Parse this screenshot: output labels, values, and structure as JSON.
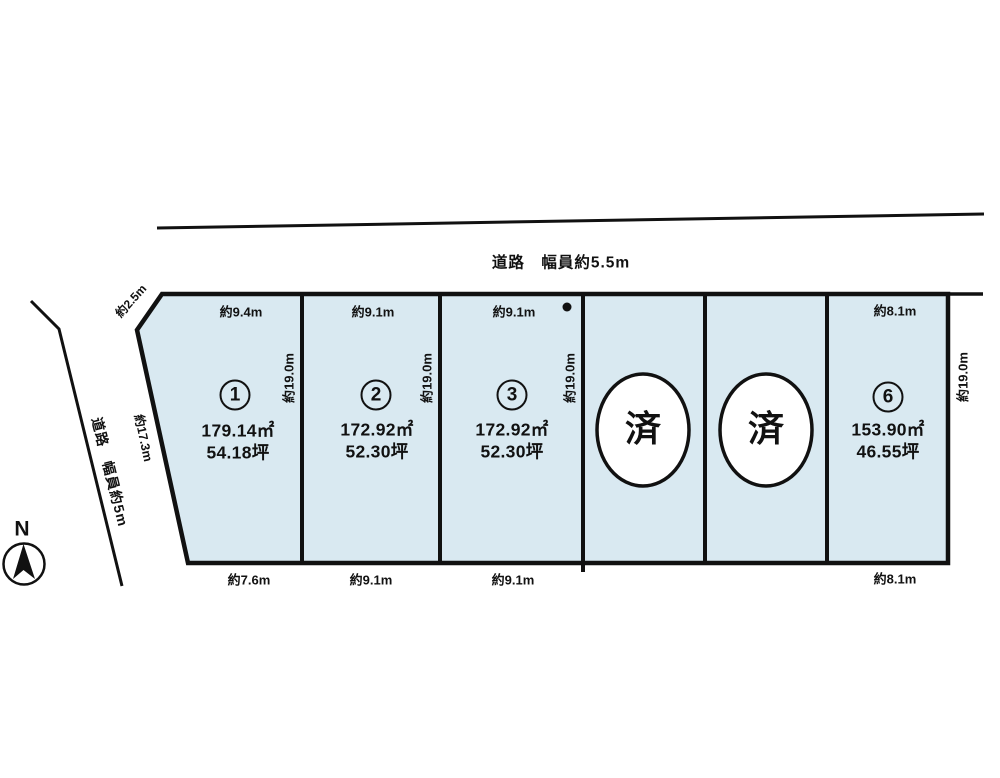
{
  "roads": {
    "top_label": "道路　幅員約5.5m",
    "left_label": "道路　幅員約5m"
  },
  "compass": {
    "north": "N"
  },
  "boundary_labels": {
    "corner_cut": "約2.5m",
    "left_slant_edge": "約17.3m"
  },
  "plots": [
    {
      "number": "1",
      "area_m2": "179.14㎡",
      "area_tsubo": "54.18坪",
      "width_top": "約9.4m",
      "width_bottom": "約7.6m",
      "depth": "約19.0m"
    },
    {
      "number": "2",
      "area_m2": "172.92㎡",
      "area_tsubo": "52.30坪",
      "width_top": "約9.1m",
      "width_bottom": "約9.1m",
      "depth": "約19.0m"
    },
    {
      "number": "3",
      "area_m2": "172.92㎡",
      "area_tsubo": "52.30坪",
      "width_top": "約9.1m",
      "width_bottom": "約9.1m",
      "depth": "約19.0m"
    },
    {
      "number": "4",
      "status": "済"
    },
    {
      "number": "5",
      "status": "済"
    },
    {
      "number": "6",
      "area_m2": "153.90㎡",
      "area_tsubo": "46.55坪",
      "width_top": "約8.1m",
      "width_bottom": "約8.1m",
      "depth": "約19.0m"
    }
  ],
  "colors": {
    "plot_fill": "#d9e9f1",
    "line": "#111111",
    "sold_circle_fill": "#ffffff"
  }
}
